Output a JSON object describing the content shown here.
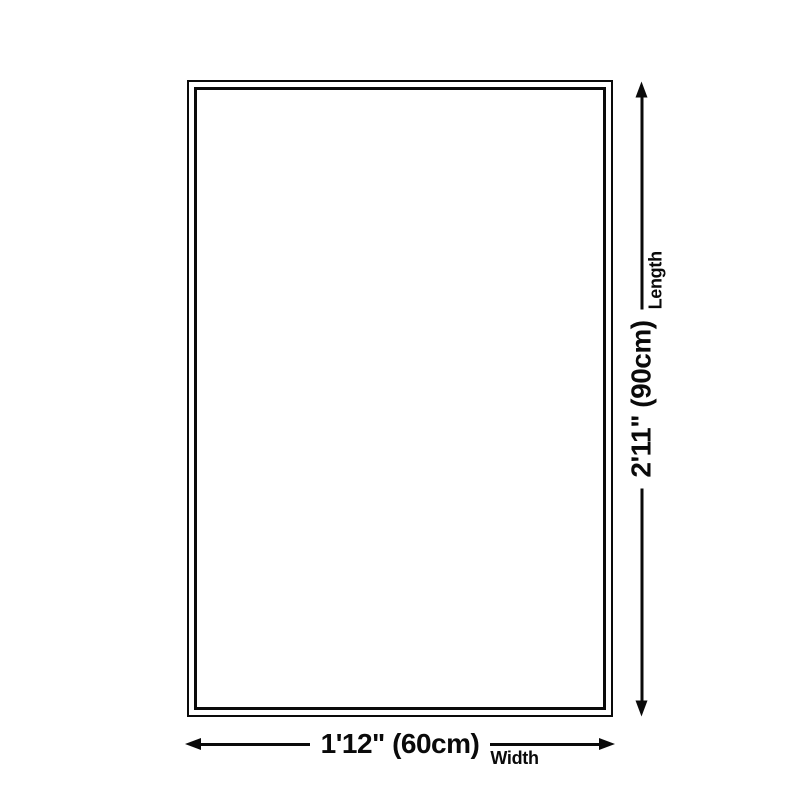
{
  "page": {
    "background_color": "#ffffff",
    "line_color": "#0a0a0a",
    "text_color": "#0a0a0a"
  },
  "diagram": {
    "type": "product-size-diagram",
    "rug": {
      "border_style": "double",
      "border_color": "#0a0a0a",
      "fill_color": "#ffffff"
    },
    "width": {
      "value": "1'12\" (60cm)",
      "label": "Width"
    },
    "length": {
      "value": "2'11\" (90cm)",
      "label": "Length"
    }
  }
}
